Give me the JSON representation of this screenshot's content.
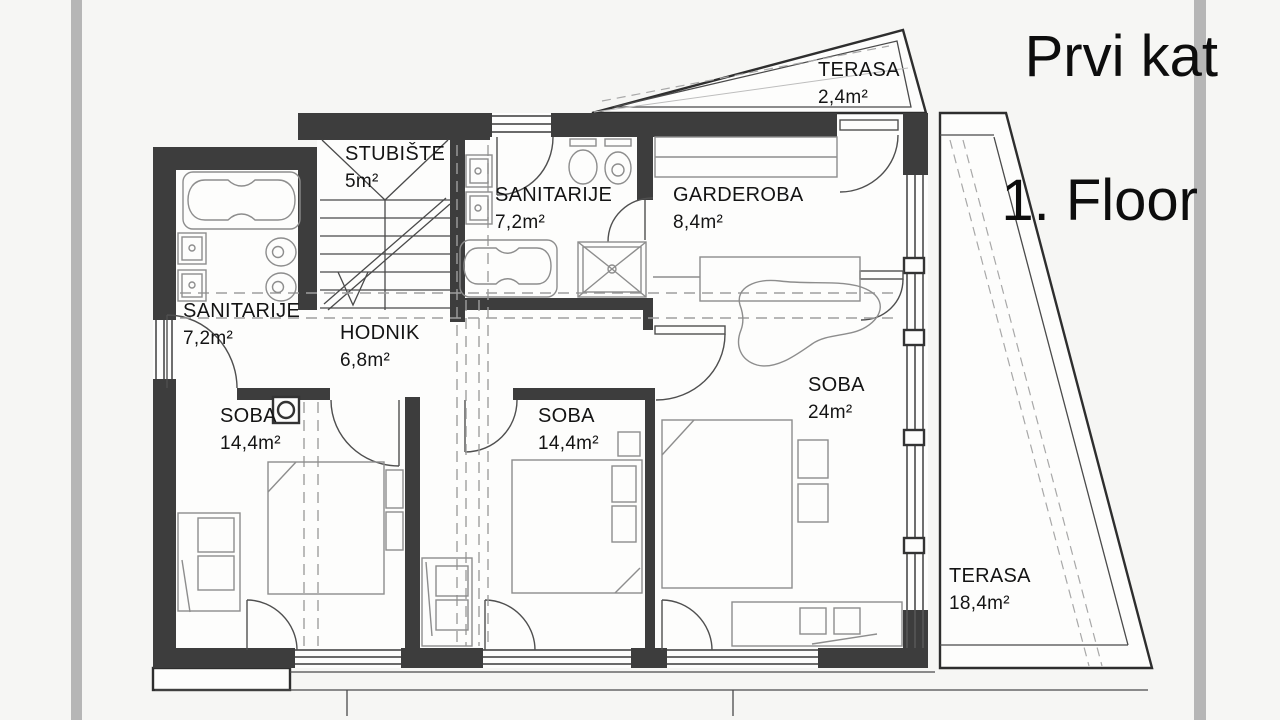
{
  "title": {
    "line1": "Prvi kat",
    "line2": "1. Floor"
  },
  "rooms": [
    {
      "name": "TERASA",
      "area": "2,4m²"
    },
    {
      "name": "STUBIŠTE",
      "area": "5m²"
    },
    {
      "name": "SANITARIJE",
      "area": "7,2m²"
    },
    {
      "name": "GARDEROBA",
      "area": "8,4m²"
    },
    {
      "name": "SANITARIJE",
      "area": "7,2m²"
    },
    {
      "name": "HODNIK",
      "area": "6,8m²"
    },
    {
      "name": "SOBA",
      "area": "14,4m²"
    },
    {
      "name": "SOBA",
      "area": "14,4m²"
    },
    {
      "name": "SOBA",
      "area": "24m²"
    },
    {
      "name": "TERASA",
      "area": "18,4m²"
    }
  ],
  "colors": {
    "wall": "#3d3d3d",
    "line": "#4a4a4a",
    "furniture": "#8d8d8d",
    "dashes": "#9f9f9f",
    "side_bars": "#b6b6b6",
    "background": "#f6f6f4",
    "paper": "#fdfdfc",
    "text": "#141414"
  }
}
